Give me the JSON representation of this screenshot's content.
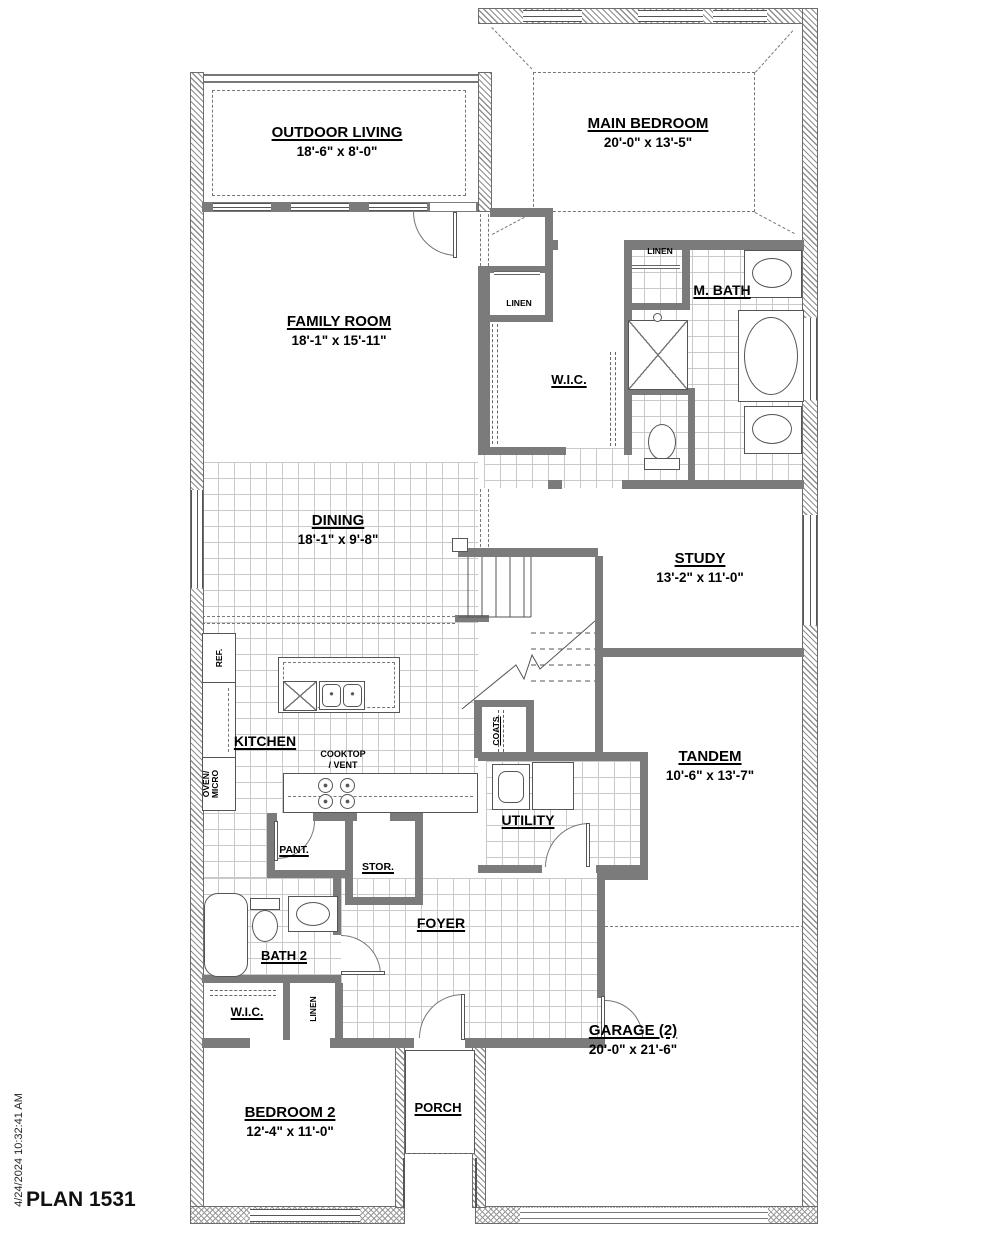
{
  "meta": {
    "plan_title": "PLAN 1531",
    "timestamp": "4/24/2024 10:32:41 AM"
  },
  "colors": {
    "wall": "#7b7b7b",
    "line": "#555555",
    "tile_line": "#c9c9c9",
    "text": "#000000",
    "background": "#ffffff"
  },
  "rooms": {
    "outdoor_living": {
      "name": "OUTDOOR LIVING",
      "dims": "18'-6\" x 8'-0\""
    },
    "main_bedroom": {
      "name": "MAIN BEDROOM",
      "dims": "20'-0\" x 13'-5\""
    },
    "family_room": {
      "name": "FAMILY ROOM",
      "dims": "18'-1\" x 15'-11\""
    },
    "m_bath": {
      "name": "M. BATH"
    },
    "wic_main": {
      "name": "W.I.C."
    },
    "linen_hall": {
      "name": "LINEN"
    },
    "linen_mbath": {
      "name": "LINEN"
    },
    "dining": {
      "name": "DINING",
      "dims": "18'-1\" x 9'-8\""
    },
    "study": {
      "name": "STUDY",
      "dims": "13'-2\" x 11'-0\""
    },
    "kitchen": {
      "name": "KITCHEN"
    },
    "cooktop": {
      "name": "COOKTOP",
      "name2": "/ VENT"
    },
    "ref": {
      "name": "REF."
    },
    "oven_micro": {
      "name": "OVEN/",
      "name2": "MICRO"
    },
    "coats": {
      "name": "COATS"
    },
    "tandem": {
      "name": "TANDEM",
      "dims": "10'-6\" x 13'-7\""
    },
    "utility": {
      "name": "UTILITY"
    },
    "pantry": {
      "name": "PANT."
    },
    "storage": {
      "name": "STOR."
    },
    "foyer": {
      "name": "FOYER"
    },
    "bath2": {
      "name": "BATH 2"
    },
    "wic2": {
      "name": "W.I.C."
    },
    "linen2": {
      "name": "LINEN"
    },
    "bedroom2": {
      "name": "BEDROOM 2",
      "dims": "12'-4\" x 11'-0\""
    },
    "porch": {
      "name": "PORCH"
    },
    "garage": {
      "name": "GARAGE (2)",
      "dims": "20'-0\" x 21'-6\""
    }
  },
  "icons": {
    "bathtub-icon": "oval-in-rect",
    "shower-icon": "x-square",
    "toilet-icon": "ellipse-plus-tank",
    "sink-icon": "oval-basin",
    "double-sink-icon": "two-basins",
    "dishwasher-icon": "x-square",
    "cooktop-icon": "four-burner-circles",
    "washer-icon": "square-with-drum",
    "dryer-icon": "square",
    "stairs-icon": "tread-lines-with-break",
    "door-icon": "quarter-arc",
    "window-icon": "double-line-slot",
    "closet-rod-icon": "dashed-double-line",
    "shelf-icon": "double-line"
  }
}
